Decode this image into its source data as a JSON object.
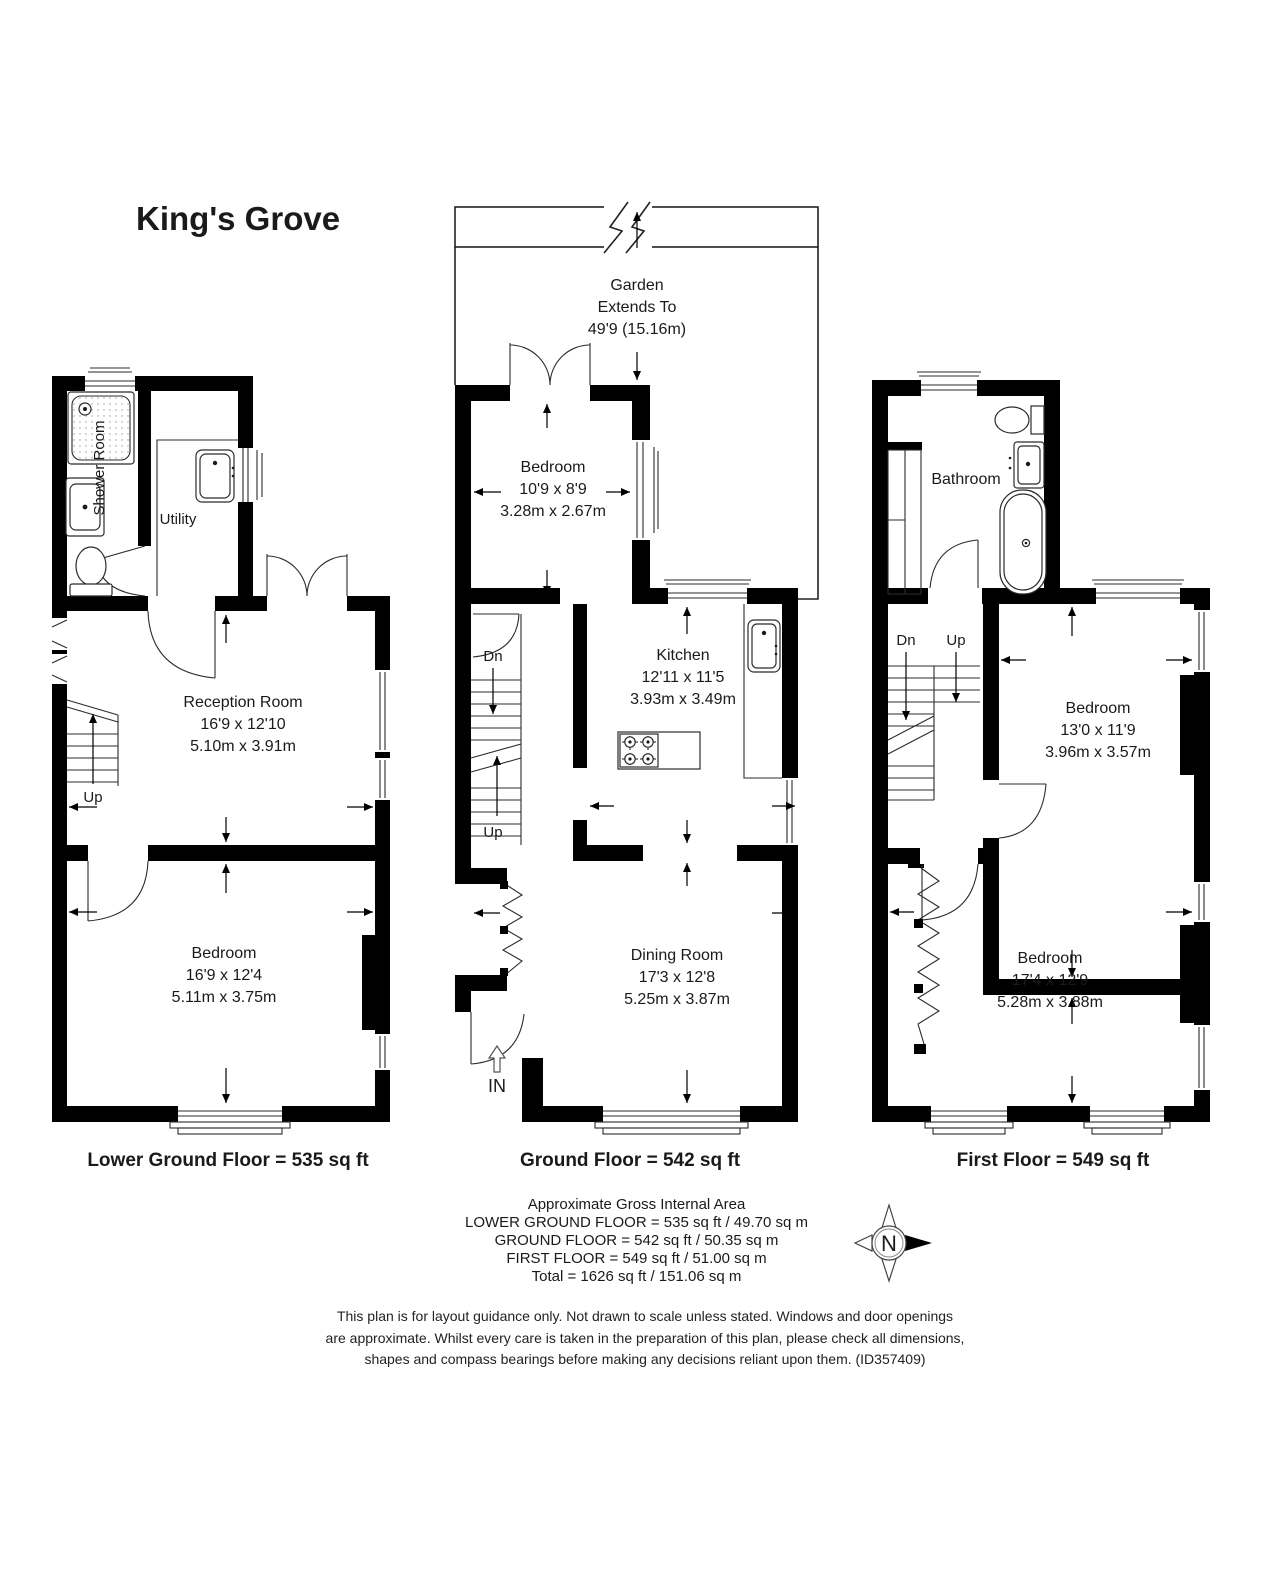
{
  "title": "King's Grove",
  "floors": {
    "lower": {
      "label": "Lower Ground Floor = 535 sq ft",
      "shower_room": "Shower Room",
      "utility": "Utility",
      "reception": {
        "name": "Reception Room",
        "imperial": "16'9 x 12'10",
        "metric": "5.10m x 3.91m"
      },
      "bedroom": {
        "name": "Bedroom",
        "imperial": "16'9 x 12'4",
        "metric": "5.11m x 3.75m"
      },
      "up": "Up"
    },
    "ground": {
      "label": "Ground Floor = 542 sq ft",
      "garden": {
        "line1": "Garden",
        "line2": "Extends To",
        "line3": "49'9 (15.16m)"
      },
      "bedroom": {
        "name": "Bedroom",
        "imperial": "10'9 x 8'9",
        "metric": "3.28m x 2.67m"
      },
      "kitchen": {
        "name": "Kitchen",
        "imperial": "12'11 x 11'5",
        "metric": "3.93m x 3.49m"
      },
      "dining": {
        "name": "Dining Room",
        "imperial": "17'3 x 12'8",
        "metric": "5.25m x 3.87m"
      },
      "dn": "Dn",
      "up": "Up",
      "entrance": "IN"
    },
    "first": {
      "label": "First Floor = 549 sq ft",
      "bathroom": "Bathroom",
      "bedroom1": {
        "name": "Bedroom",
        "imperial": "13'0 x 11'9",
        "metric": "3.96m x 3.57m"
      },
      "bedroom2": {
        "name": "Bedroom",
        "imperial": "17'4 x 12'9",
        "metric": "5.28m x 3.88m"
      },
      "dn": "Dn",
      "up": "Up"
    }
  },
  "summary": {
    "heading": "Approximate Gross Internal Area",
    "lines": [
      "LOWER GROUND FLOOR = 535 sq ft / 49.70 sq m",
      "GROUND FLOOR = 542 sq ft / 50.35 sq m",
      "FIRST FLOOR = 549 sq ft / 51.00 sq m",
      "Total = 1626 sq ft / 151.06 sq m"
    ]
  },
  "compass": {
    "north": "N"
  },
  "disclaimer": {
    "line1": "This plan is for layout guidance only. Not drawn to scale unless stated. Windows and door openings",
    "line2": "are approximate. Whilst every care is taken in the preparation of this plan, please check all dimensions,",
    "line3": "shapes and compass bearings before making any decisions reliant upon them. (ID357409)"
  },
  "colors": {
    "wall": "#000000",
    "paper": "#ffffff",
    "text": "#1a1a1a"
  }
}
